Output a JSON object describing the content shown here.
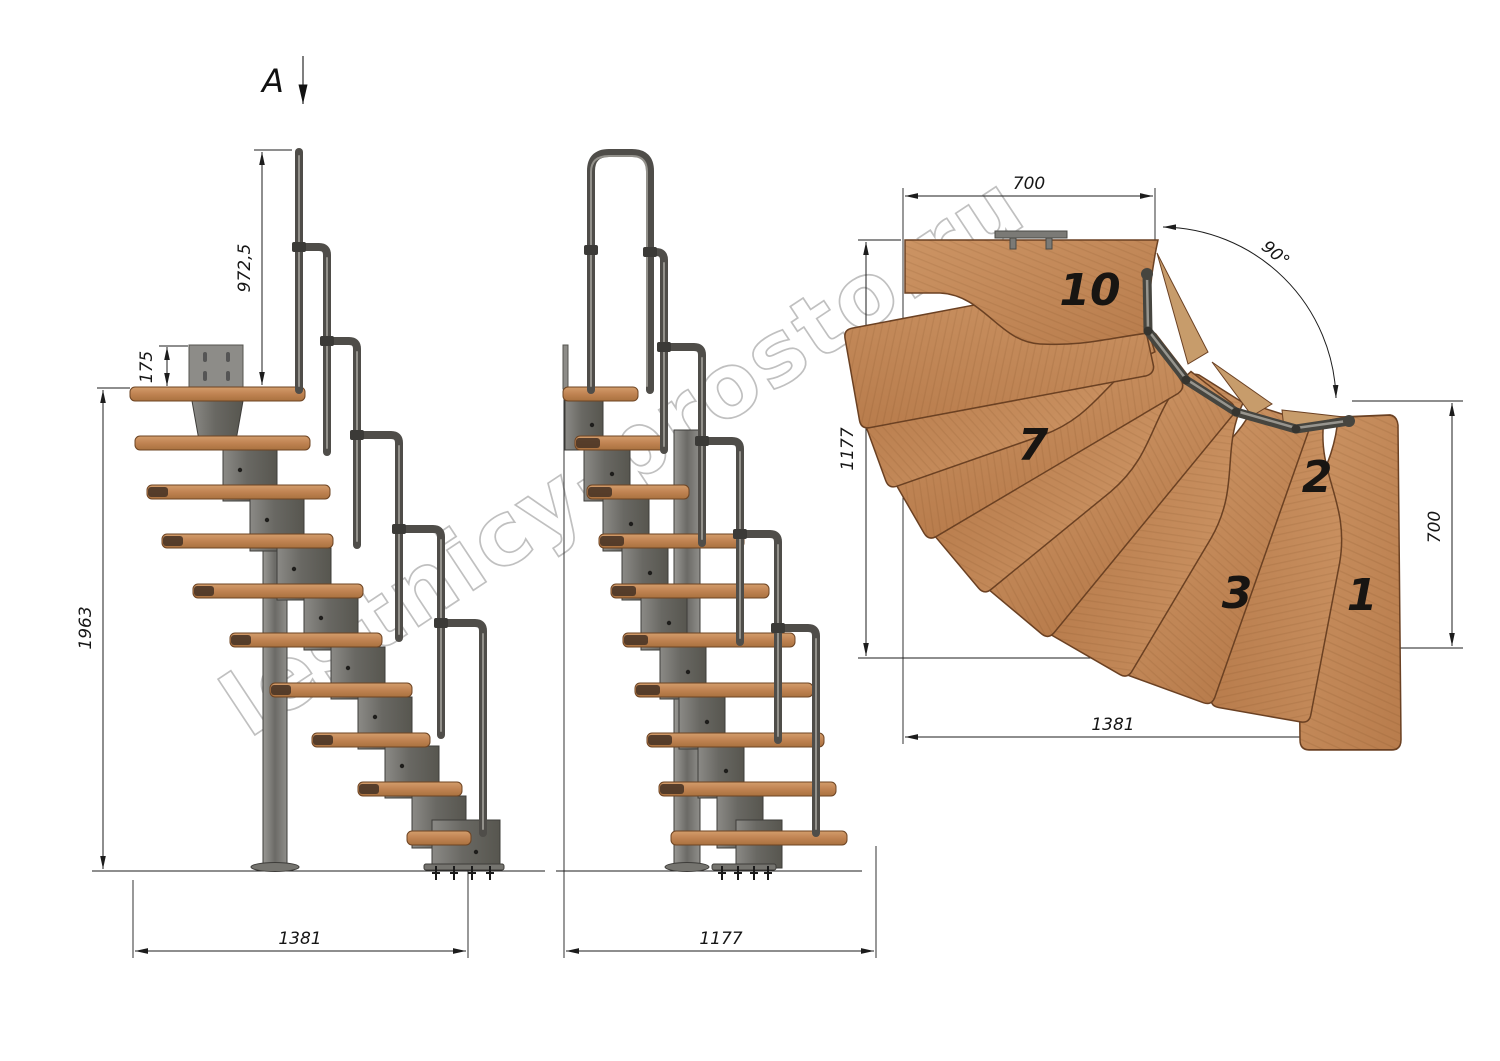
{
  "watermark": "lestnicy-prosto.ru",
  "section_view": {
    "label": "A"
  },
  "left_view": {
    "handrail_height": "972,5",
    "bracket_height": "175",
    "total_height": "1963",
    "length": "1381"
  },
  "front_view": {
    "length": "1177"
  },
  "plan_view": {
    "width_top": "700",
    "turn_angle": "90°",
    "depth_left": "1177",
    "depth_right": "700",
    "length_bottom": "1381",
    "step_labels": {
      "s1": "1",
      "s2": "2",
      "s3": "3",
      "s7": "7",
      "s10": "10"
    }
  },
  "colors": {
    "wood": "#c48b5c",
    "wood_outline": "#6b4123",
    "metal": "#72716d",
    "handrail": "#4f4d49",
    "dimension_line": "#1c1c1c",
    "watermark": "#b6b6b6",
    "background": "#ffffff"
  }
}
